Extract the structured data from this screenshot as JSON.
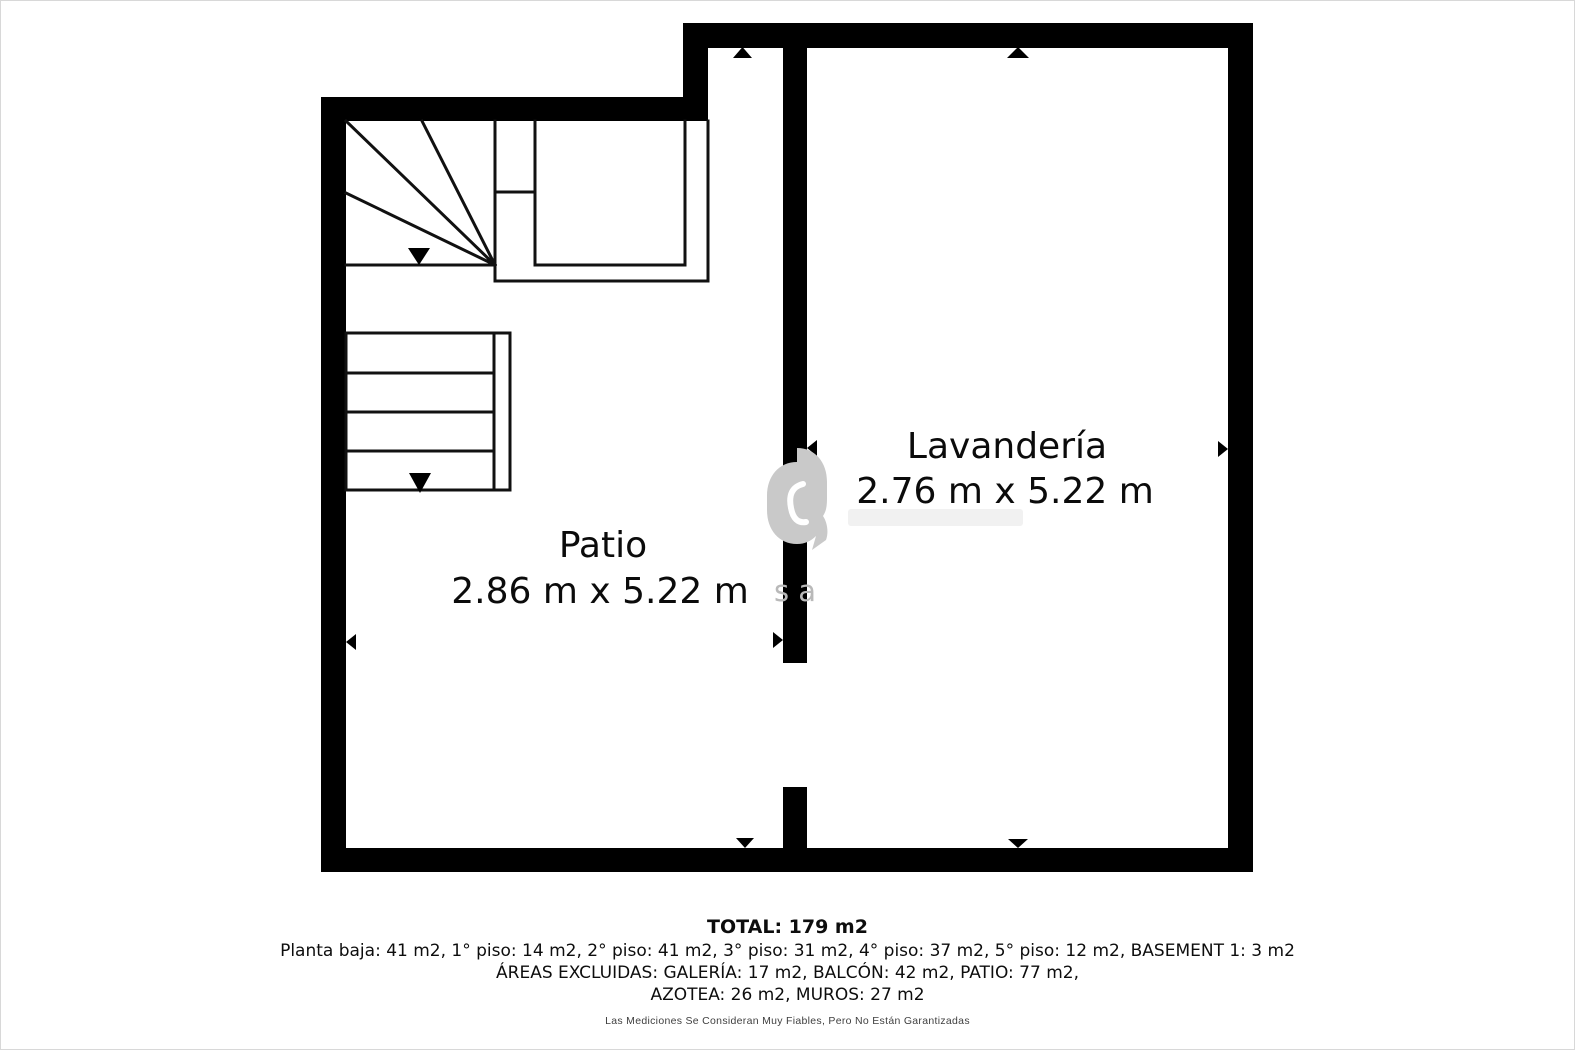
{
  "plan": {
    "rooms": [
      {
        "name": "Patio",
        "dimensions": "2.86 m x 5.22 m"
      },
      {
        "name": "Lavandería",
        "dimensions": "2.76 m x 5.22 m"
      }
    ],
    "watermark_letters": "s a"
  },
  "summary": {
    "total": "TOTAL: 179 m2",
    "floors": "Planta baja: 41 m2, 1° piso: 14 m2, 2° piso: 41 m2, 3° piso: 31 m2, 4° piso: 37 m2, 5° piso: 12 m2, BASEMENT 1: 3 m2",
    "excluded_areas": "ÁREAS EXCLUIDAS: GALERÍA: 17 m2, BALCÓN: 42 m2, PATIO: 77 m2,",
    "excluded_areas_2": "AZOTEA: 26 m2, MUROS: 27 m2",
    "disclaimer": "Las Mediciones Se Consideran Muy Fiables, Pero No Están Garantizadas"
  },
  "colors": {
    "wall": "#000000",
    "background": "#ffffff",
    "thin_line": "#111111",
    "watermark": "#c9c9c9"
  }
}
